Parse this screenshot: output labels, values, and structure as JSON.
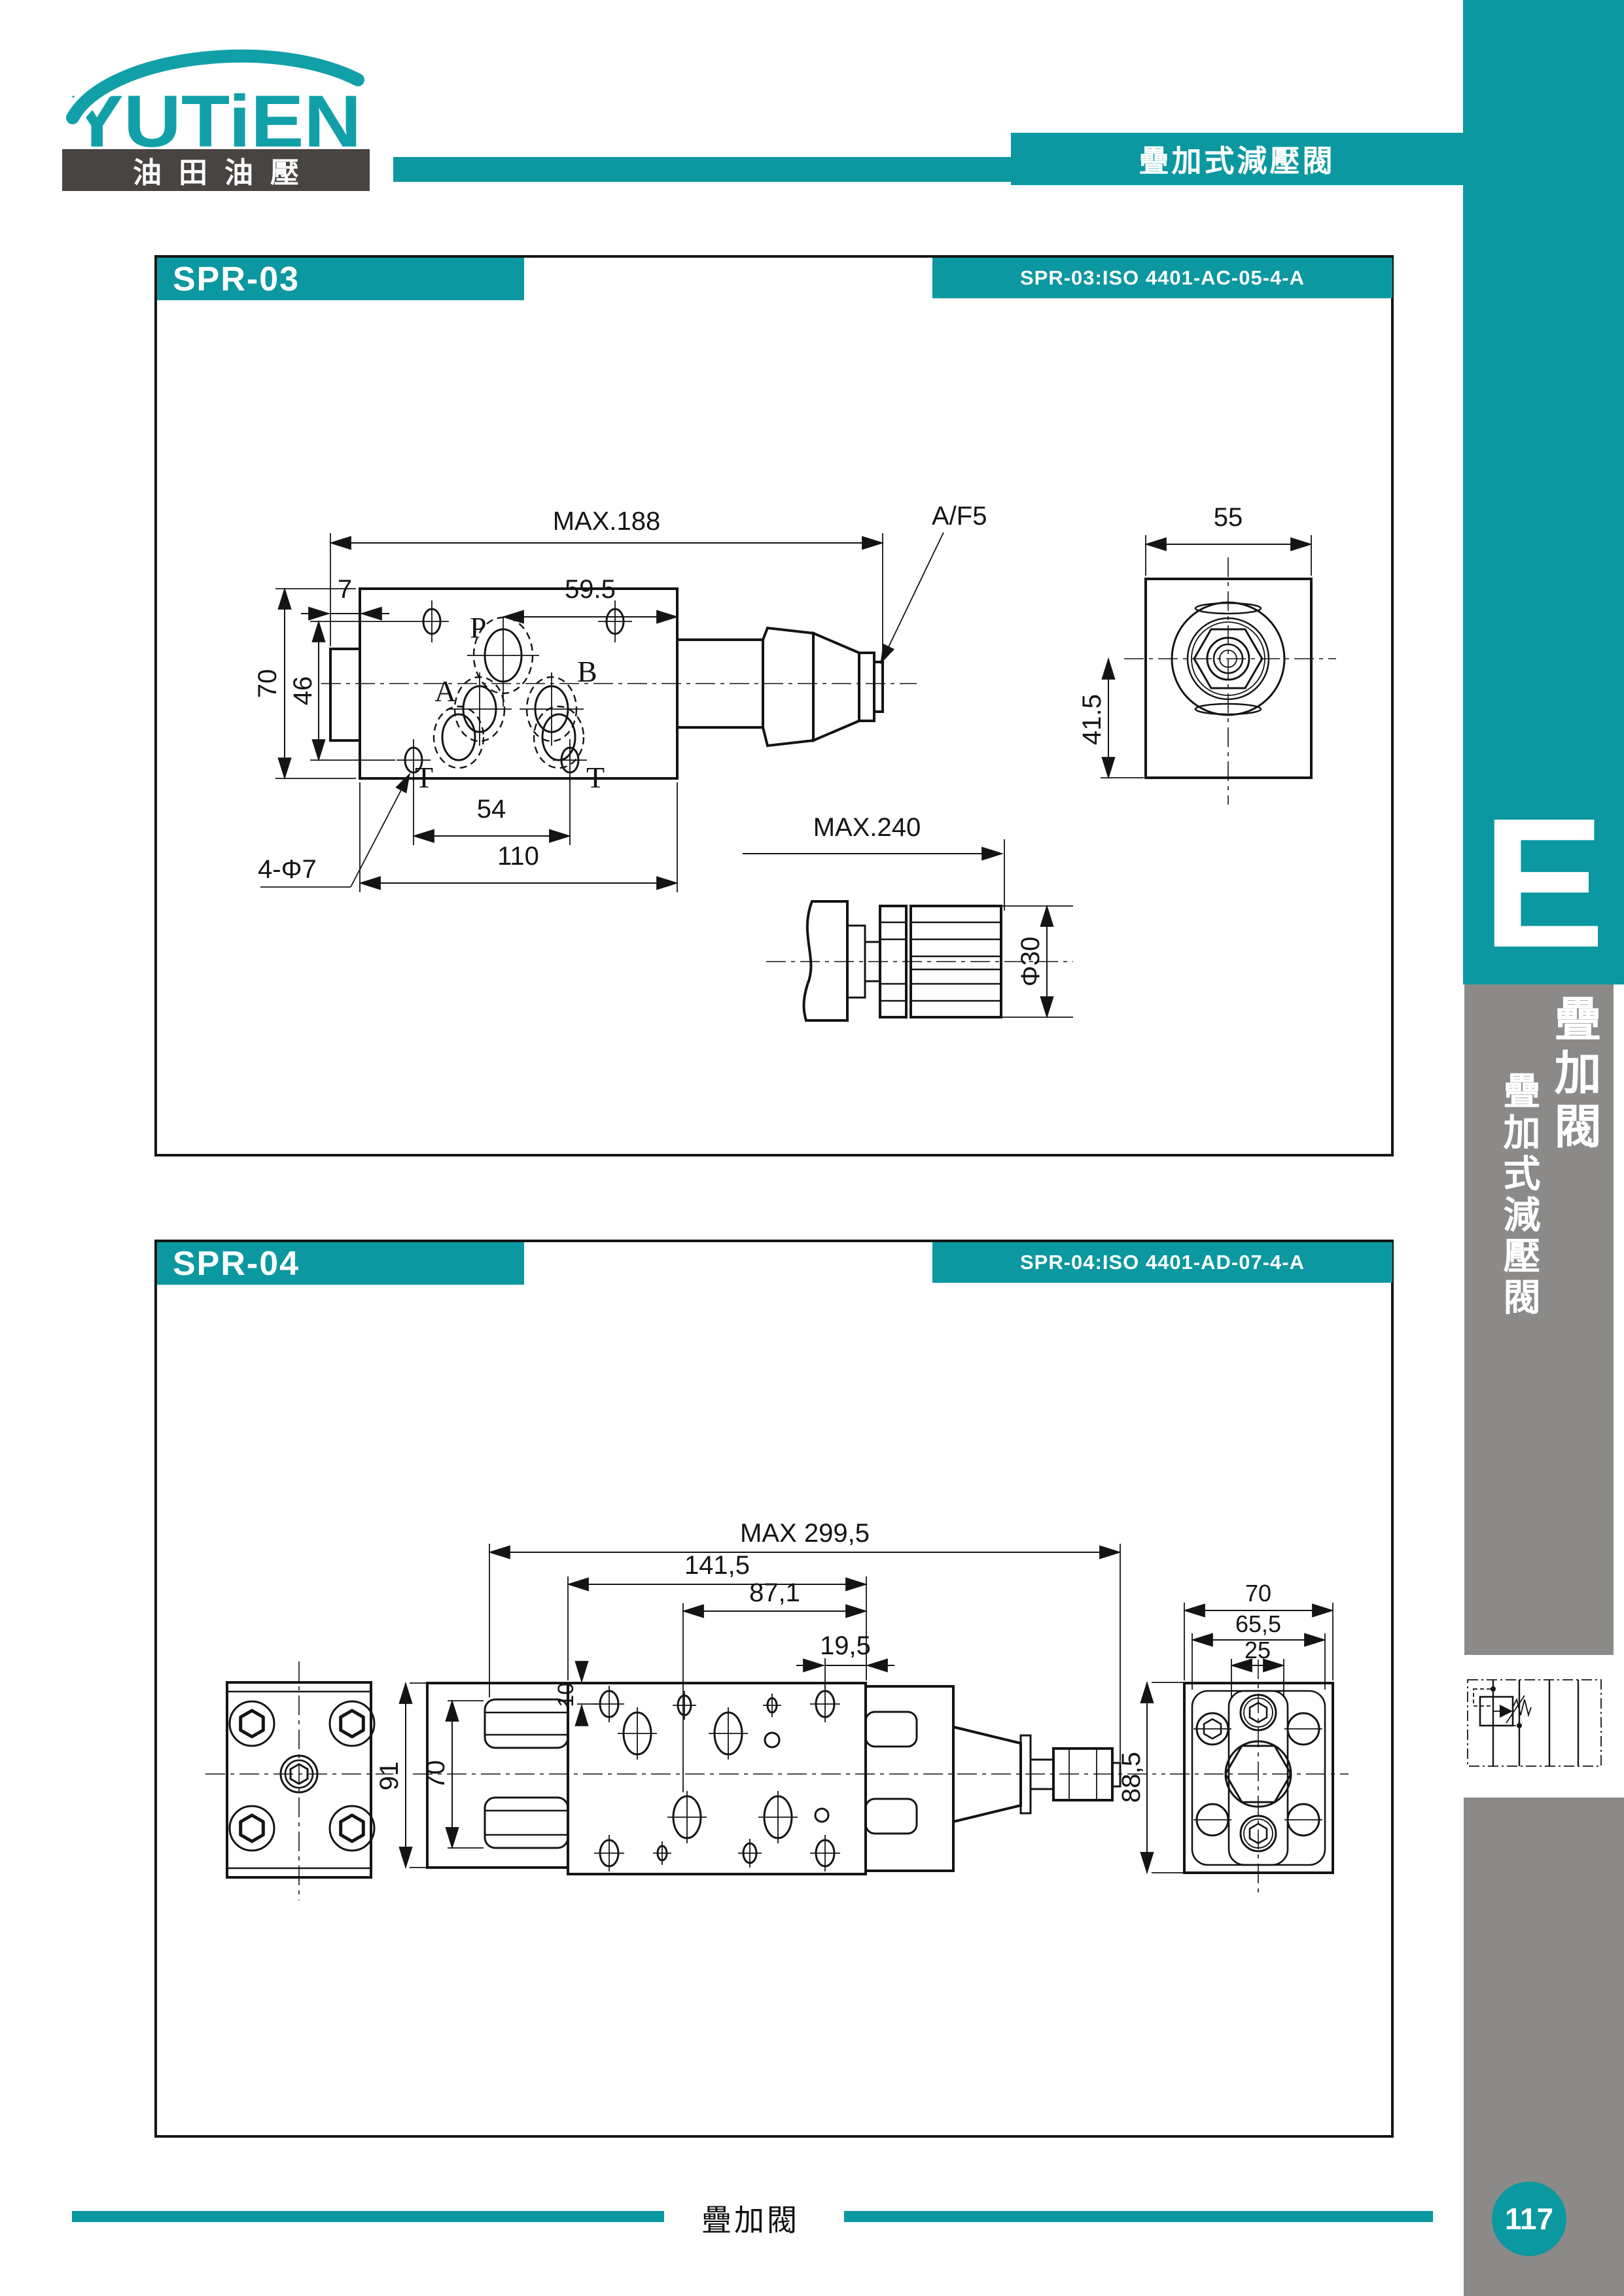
{
  "header": {
    "brand": "YUTiEN",
    "brand_sub": "油田油壓",
    "banner": "疊加式減壓閥"
  },
  "sidebar": {
    "letter": "E",
    "tab_large": "疊加閥",
    "tab_small": "疊加式減壓閥",
    "page_number": "117"
  },
  "footer": {
    "label": "疊加閥"
  },
  "colors": {
    "teal": "#0b98a0",
    "dark_gray": "#474442",
    "mid_gray": "#8c8a88",
    "line": "#141414"
  },
  "sections": [
    {
      "title": "SPR-03",
      "iso": "SPR-03:ISO 4401-AC-05-4-A",
      "ports": {
        "p": "P",
        "a": "A",
        "b": "B",
        "t_left": "T",
        "t_right": "T"
      },
      "dims": {
        "overall_length": "MAX.188",
        "tab_offset": "7",
        "port_to_edge": "59.5",
        "body_height": "70",
        "hole_spacing_v": "46",
        "hole_spacing_h": "54",
        "body_width": "110",
        "mounting_holes": "4-Φ7",
        "wrench_flat": "A/F5",
        "side_width": "55",
        "side_height": "41.5",
        "knob_length": "MAX.240",
        "knob_diameter": "Φ30"
      }
    },
    {
      "title": "SPR-04",
      "iso": "SPR-04:ISO 4401-AD-07-4-A",
      "dims": {
        "overall_length": "MAX 299,5",
        "body_width": "141,5",
        "port_span": "87,1",
        "edge_offset": "19,5",
        "top_offset": "10",
        "flange_height": "91",
        "plate_height": "70",
        "side_width": "70",
        "side_width_inner": "65,5",
        "side_hole_spacing": "25",
        "side_height": "88,5"
      }
    }
  ]
}
